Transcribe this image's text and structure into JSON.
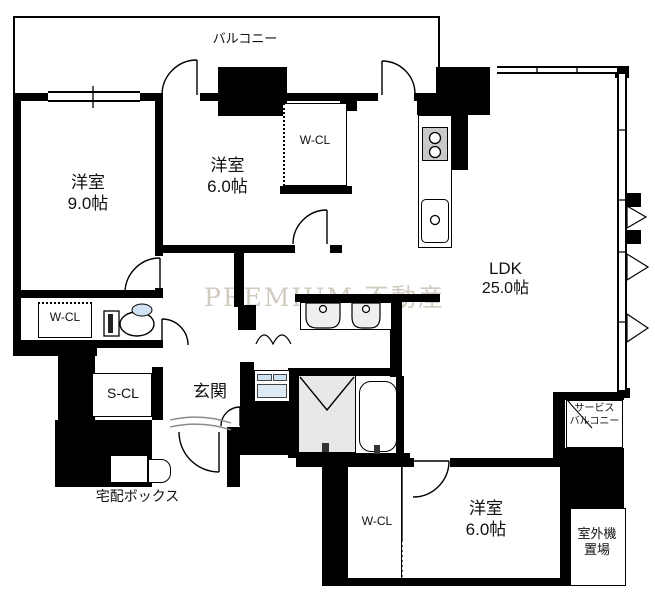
{
  "floorplan": {
    "watermark": "PREMIUM 不動産",
    "balcony": {
      "label": "バルコニー"
    },
    "bedroom_9": {
      "name": "洋室",
      "size": "9.0帖"
    },
    "bedroom_6_upper": {
      "name": "洋室",
      "size": "6.0帖"
    },
    "walkin_closet_upper": {
      "label": "W-CL"
    },
    "ldk": {
      "name": "LDK",
      "size": "25.0帖"
    },
    "walkin_closet_left": {
      "label": "W-CL"
    },
    "shoes_closet": {
      "label": "S-CL"
    },
    "entrance": {
      "label": "玄関"
    },
    "delivery_box": {
      "label": "宅配ボックス"
    },
    "walkin_closet_lower": {
      "label": "W-CL"
    },
    "bedroom_6_lower": {
      "name": "洋室",
      "size": "6.0帖"
    },
    "service_balcony": {
      "line1": "サービス",
      "line2": "バルコニー"
    },
    "outdoor_unit": {
      "line1": "室外機",
      "line2": "置場"
    }
  }
}
